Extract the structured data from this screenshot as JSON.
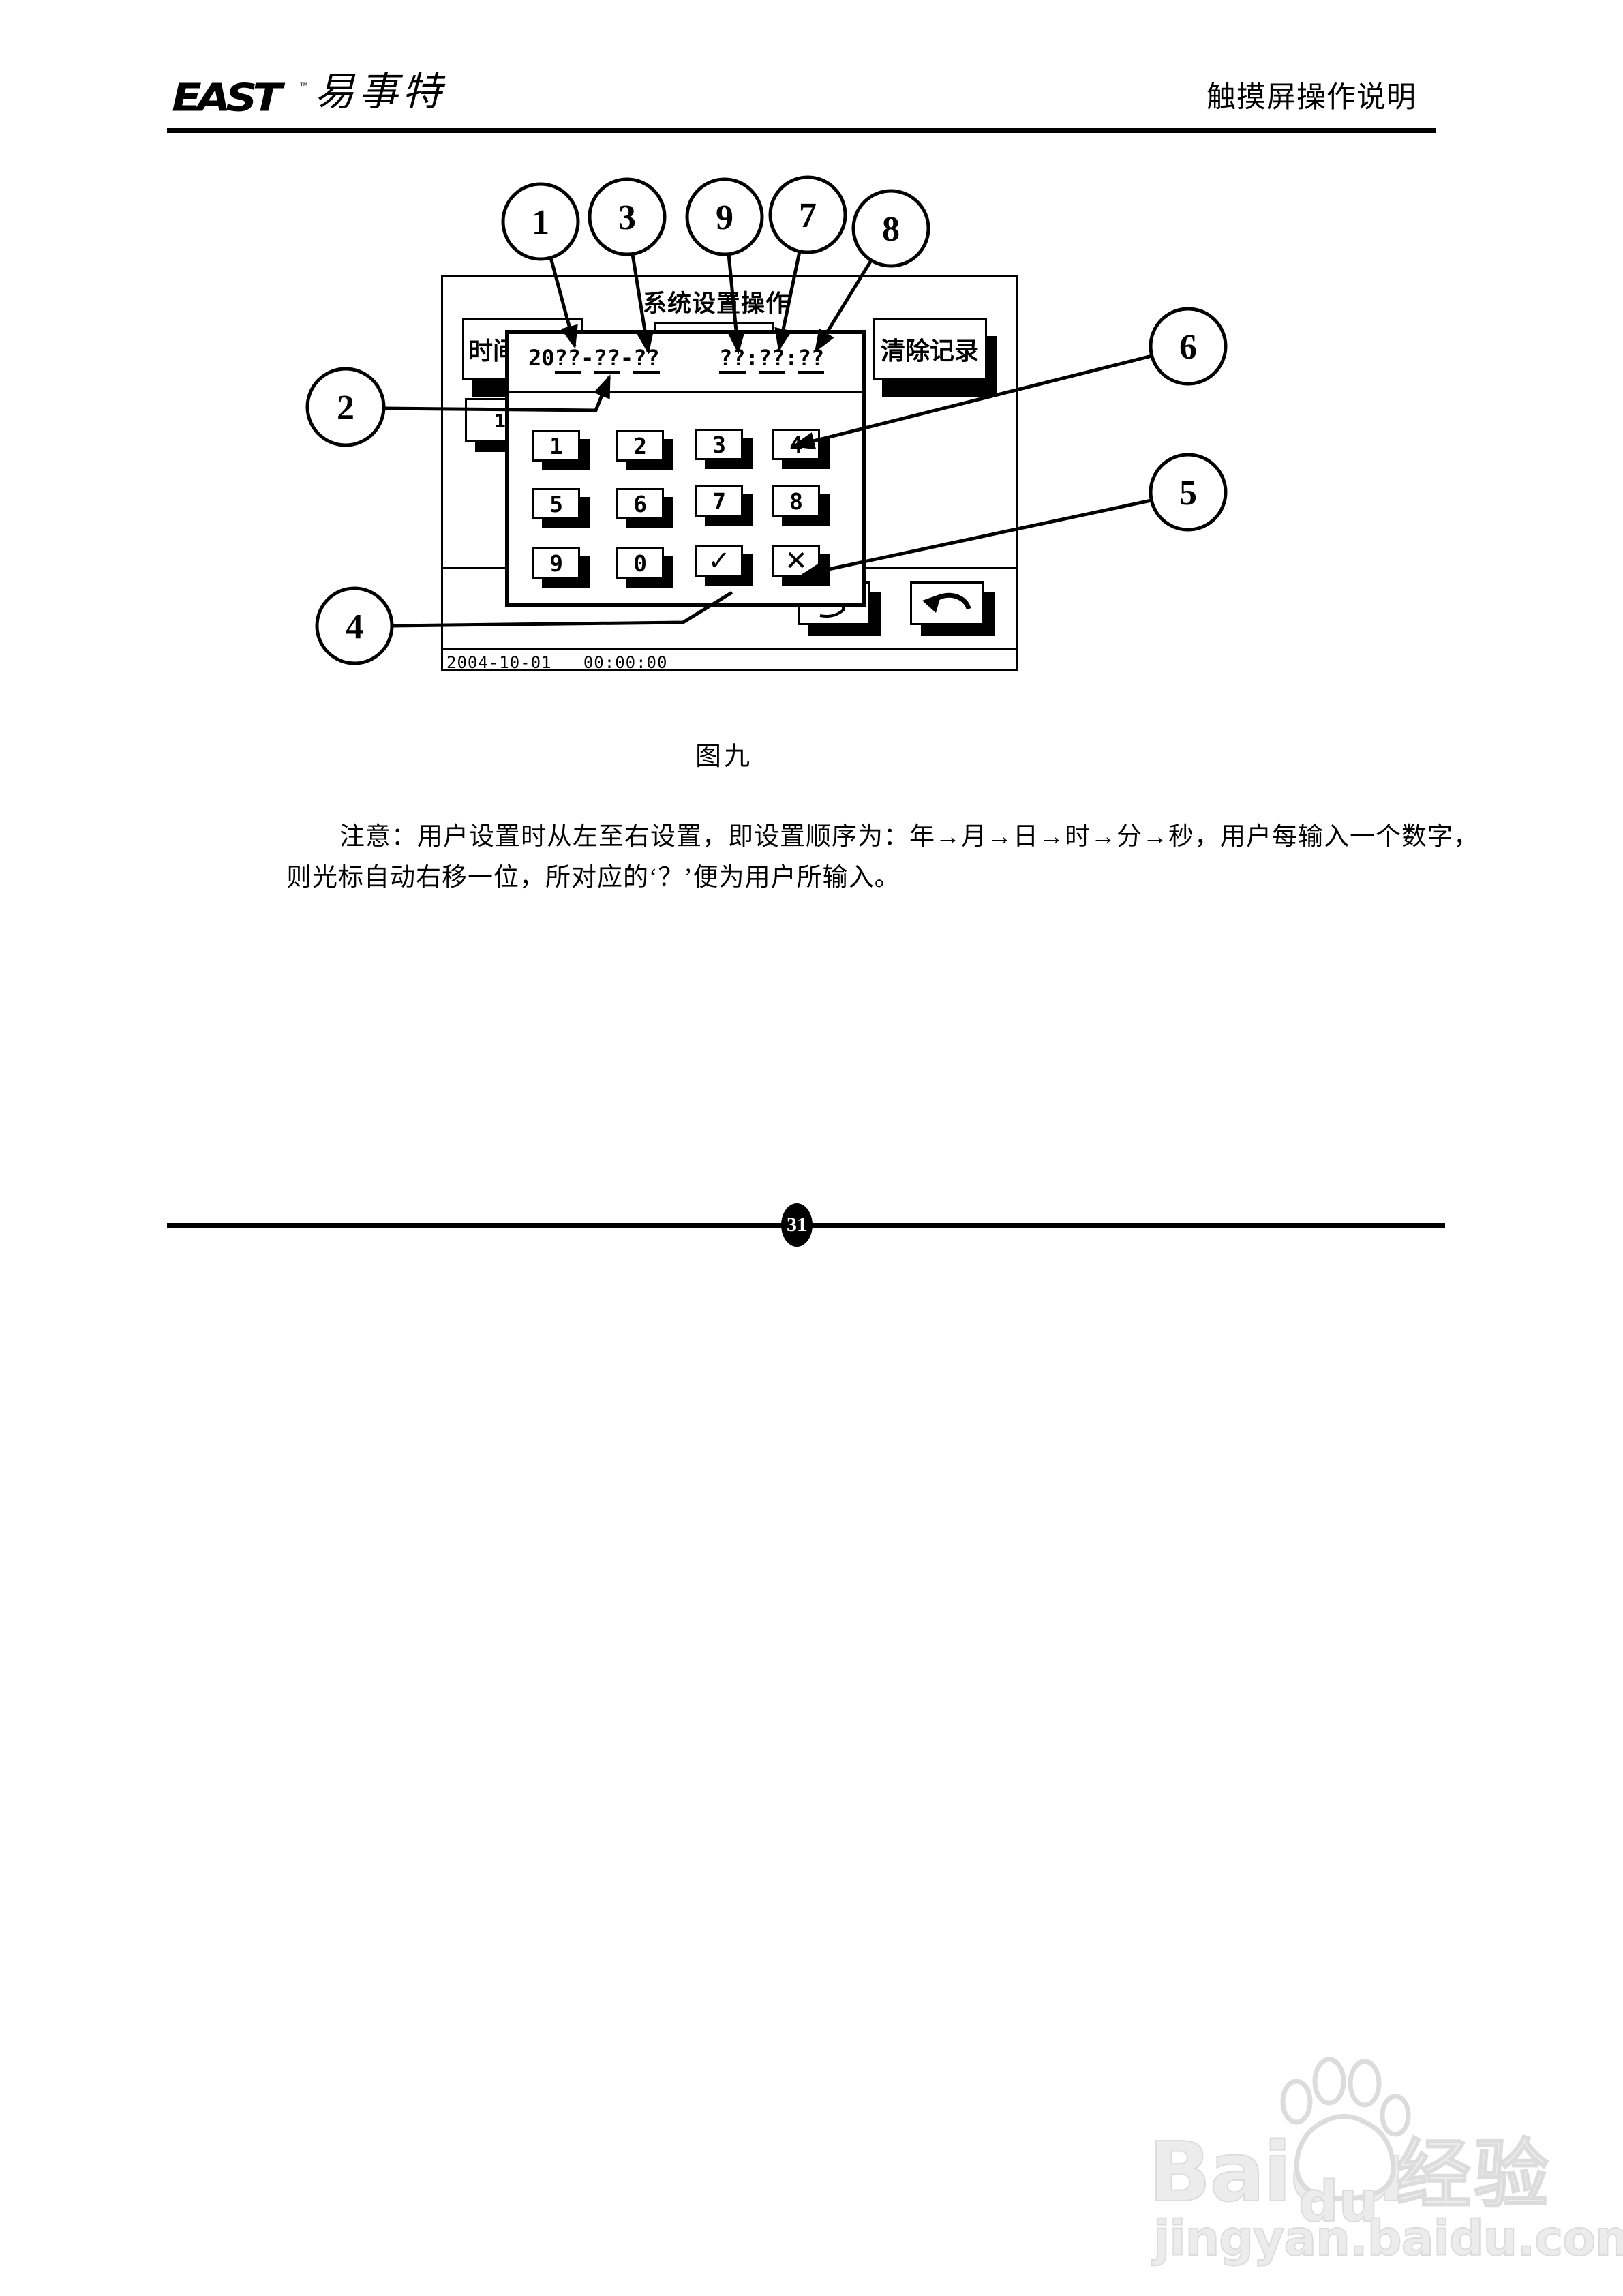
{
  "header": {
    "logo_text": "EAST",
    "logo_tm": "™",
    "brand_cn": "易事特",
    "doc_title": "触摸屏操作说明"
  },
  "figure": {
    "screen": {
      "title": "系统设置操作",
      "time_setting_button": "时间设置",
      "clear_records_button": "清除记录",
      "hidden_button_fragment": "1",
      "status_bar": "2004-10-01   00:00:00",
      "dialog": {
        "date": {
          "century": "20",
          "year": "??",
          "dash1": "-",
          "month": "??",
          "dash2": "-",
          "day": "??"
        },
        "time": {
          "hour": "??",
          "colon1": ":",
          "minute": "??",
          "colon2": ":",
          "second": "??"
        },
        "keys": [
          "1",
          "2",
          "3",
          "4",
          "5",
          "6",
          "7",
          "8",
          "9",
          "0",
          "✓",
          "✕"
        ]
      }
    },
    "callouts": {
      "c1": "1",
      "c2": "2",
      "c3": "3",
      "c4": "4",
      "c5": "5",
      "c6": "6",
      "c7": "7",
      "c8": "8",
      "c9": "9"
    },
    "caption": "图九"
  },
  "note": {
    "line1": "注意：用户设置时从左至右设置，即设置顺序为：年→月→日→时→分→秒，用户每输入一个数字，",
    "line2": "则光标自动右移一位，所对应的‘？’便为用户所输入。"
  },
  "footer": {
    "page_number": "31"
  },
  "watermark": {
    "brand": "Baidu",
    "paw_text": "du",
    "suffix": "经验",
    "url": "jingyan.baidu.com"
  }
}
